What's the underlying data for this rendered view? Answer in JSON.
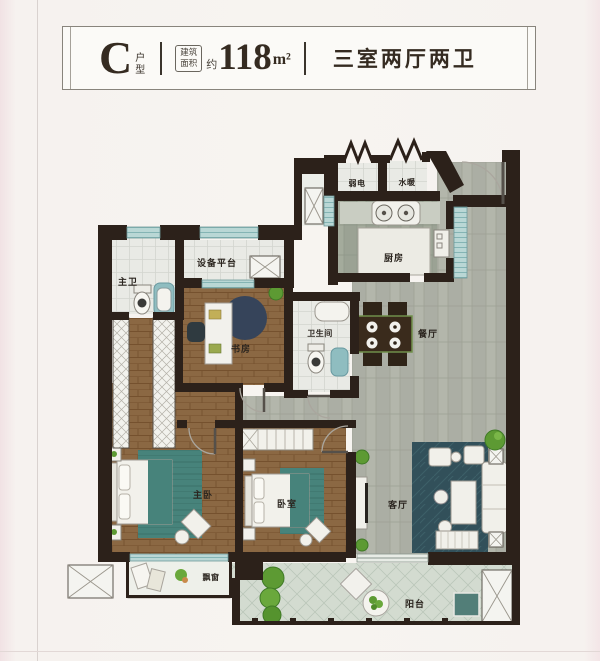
{
  "header": {
    "type_letter": "C",
    "type_suffix": "户型",
    "area_label": "建筑面积",
    "area_approx": "约",
    "area_value": "118",
    "area_unit": "m²",
    "layout_text": "三室两厅两卫"
  },
  "rooms": {
    "weak_power": "弱电",
    "plumbing": "水暖",
    "kitchen": "厨房",
    "equipment_platform": "设备平台",
    "master_bath": "主卫",
    "study": "书房",
    "bathroom": "卫生间",
    "dining": "餐厅",
    "master_bedroom": "主卧",
    "bedroom": "卧室",
    "living": "客厅",
    "bay_window": "飘窗",
    "balcony": "阳台"
  },
  "colors": {
    "wall": "#2c211a",
    "wood_floor": "#8b6843",
    "tile_gray": "#abaea4",
    "tile_kitchen": "#9ba294",
    "tile_white": "#e9eae5",
    "window_teal": "#b9d7d5",
    "rug_living": "#32505a",
    "rug_study": "#36445a",
    "rug_bedroom_teal": "#47837b",
    "plant_green": "#5d9a33",
    "label_text": "#2b251f"
  }
}
